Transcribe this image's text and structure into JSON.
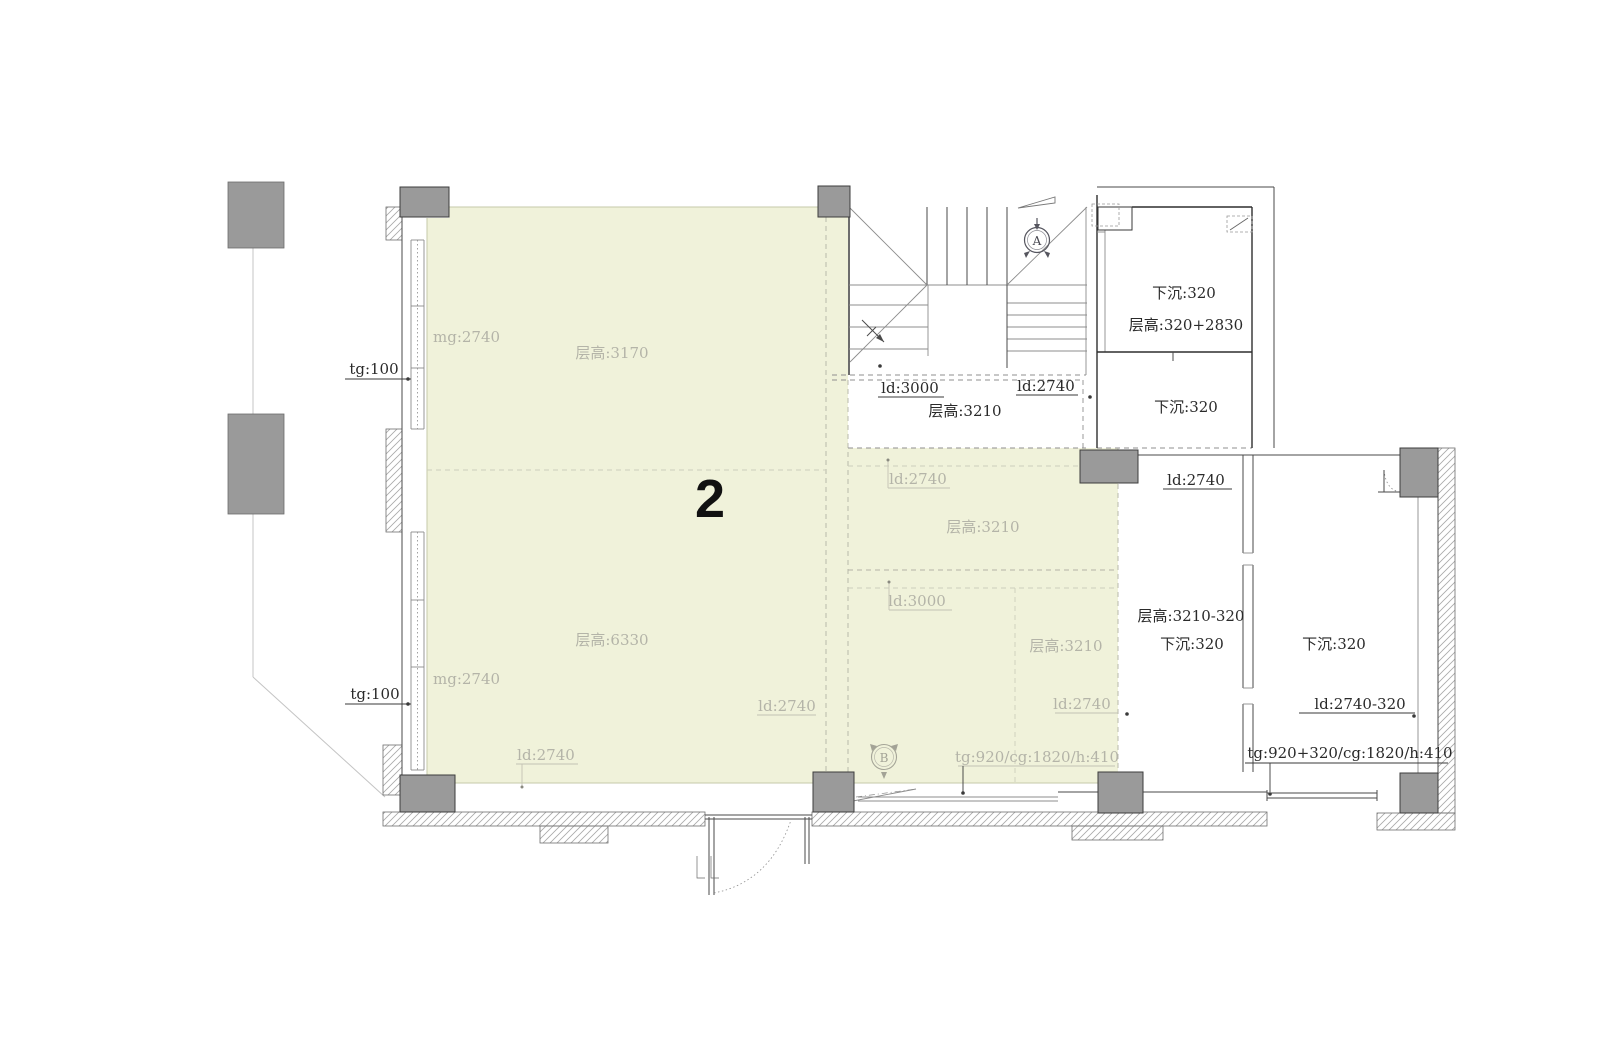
{
  "colors": {
    "room_highlight": "#f0f2da",
    "column_gray": "#9a9a9a",
    "wall_dark": "#2f2f2f",
    "label_light": "#b4b4a8",
    "label_dark": "#2a2a2a",
    "background": "#ffffff"
  },
  "plan": {
    "labels": {
      "room_number": "2",
      "tg100_top": "tg:100",
      "mg2740_top": "mg:2740",
      "cg3170": "层高:3170",
      "cg6330": "层高:6330",
      "mg2740_bottom": "mg:2740",
      "tg100_bottom": "tg:100",
      "ld2740_bottom_left": "ld:2740",
      "ld2740_left_mid": "ld:2740",
      "ld2740_right_top": "ld:2740",
      "cg3210_right_top": "层高:3210",
      "ld3000_right": "ld:3000",
      "cg3210_right_mid": "层高:3210",
      "ld2740_right_bottom": "ld:2740",
      "tg920": "tg:920/cg:1820/h:410",
      "ld3000_stair": "ld:3000",
      "ld2740_stair": "ld:2740",
      "cg3210_stair": "层高:3210",
      "xiachen320_top": "下沉:320",
      "cg320_2830": "层高:320+2830",
      "xiachen320_mid": "下沉:320",
      "ld2740_lower_right": "ld:2740",
      "cg3210_minus320": "层高:3210-320",
      "xiachen320_room_left": "下沉:320",
      "xiachen320_room_right": "下沉:320",
      "ld2740_minus320": "ld:2740-320",
      "tg920_320": "tg:920+320/cg:1820/h:410",
      "marker_a": "A",
      "marker_b": "B"
    }
  }
}
